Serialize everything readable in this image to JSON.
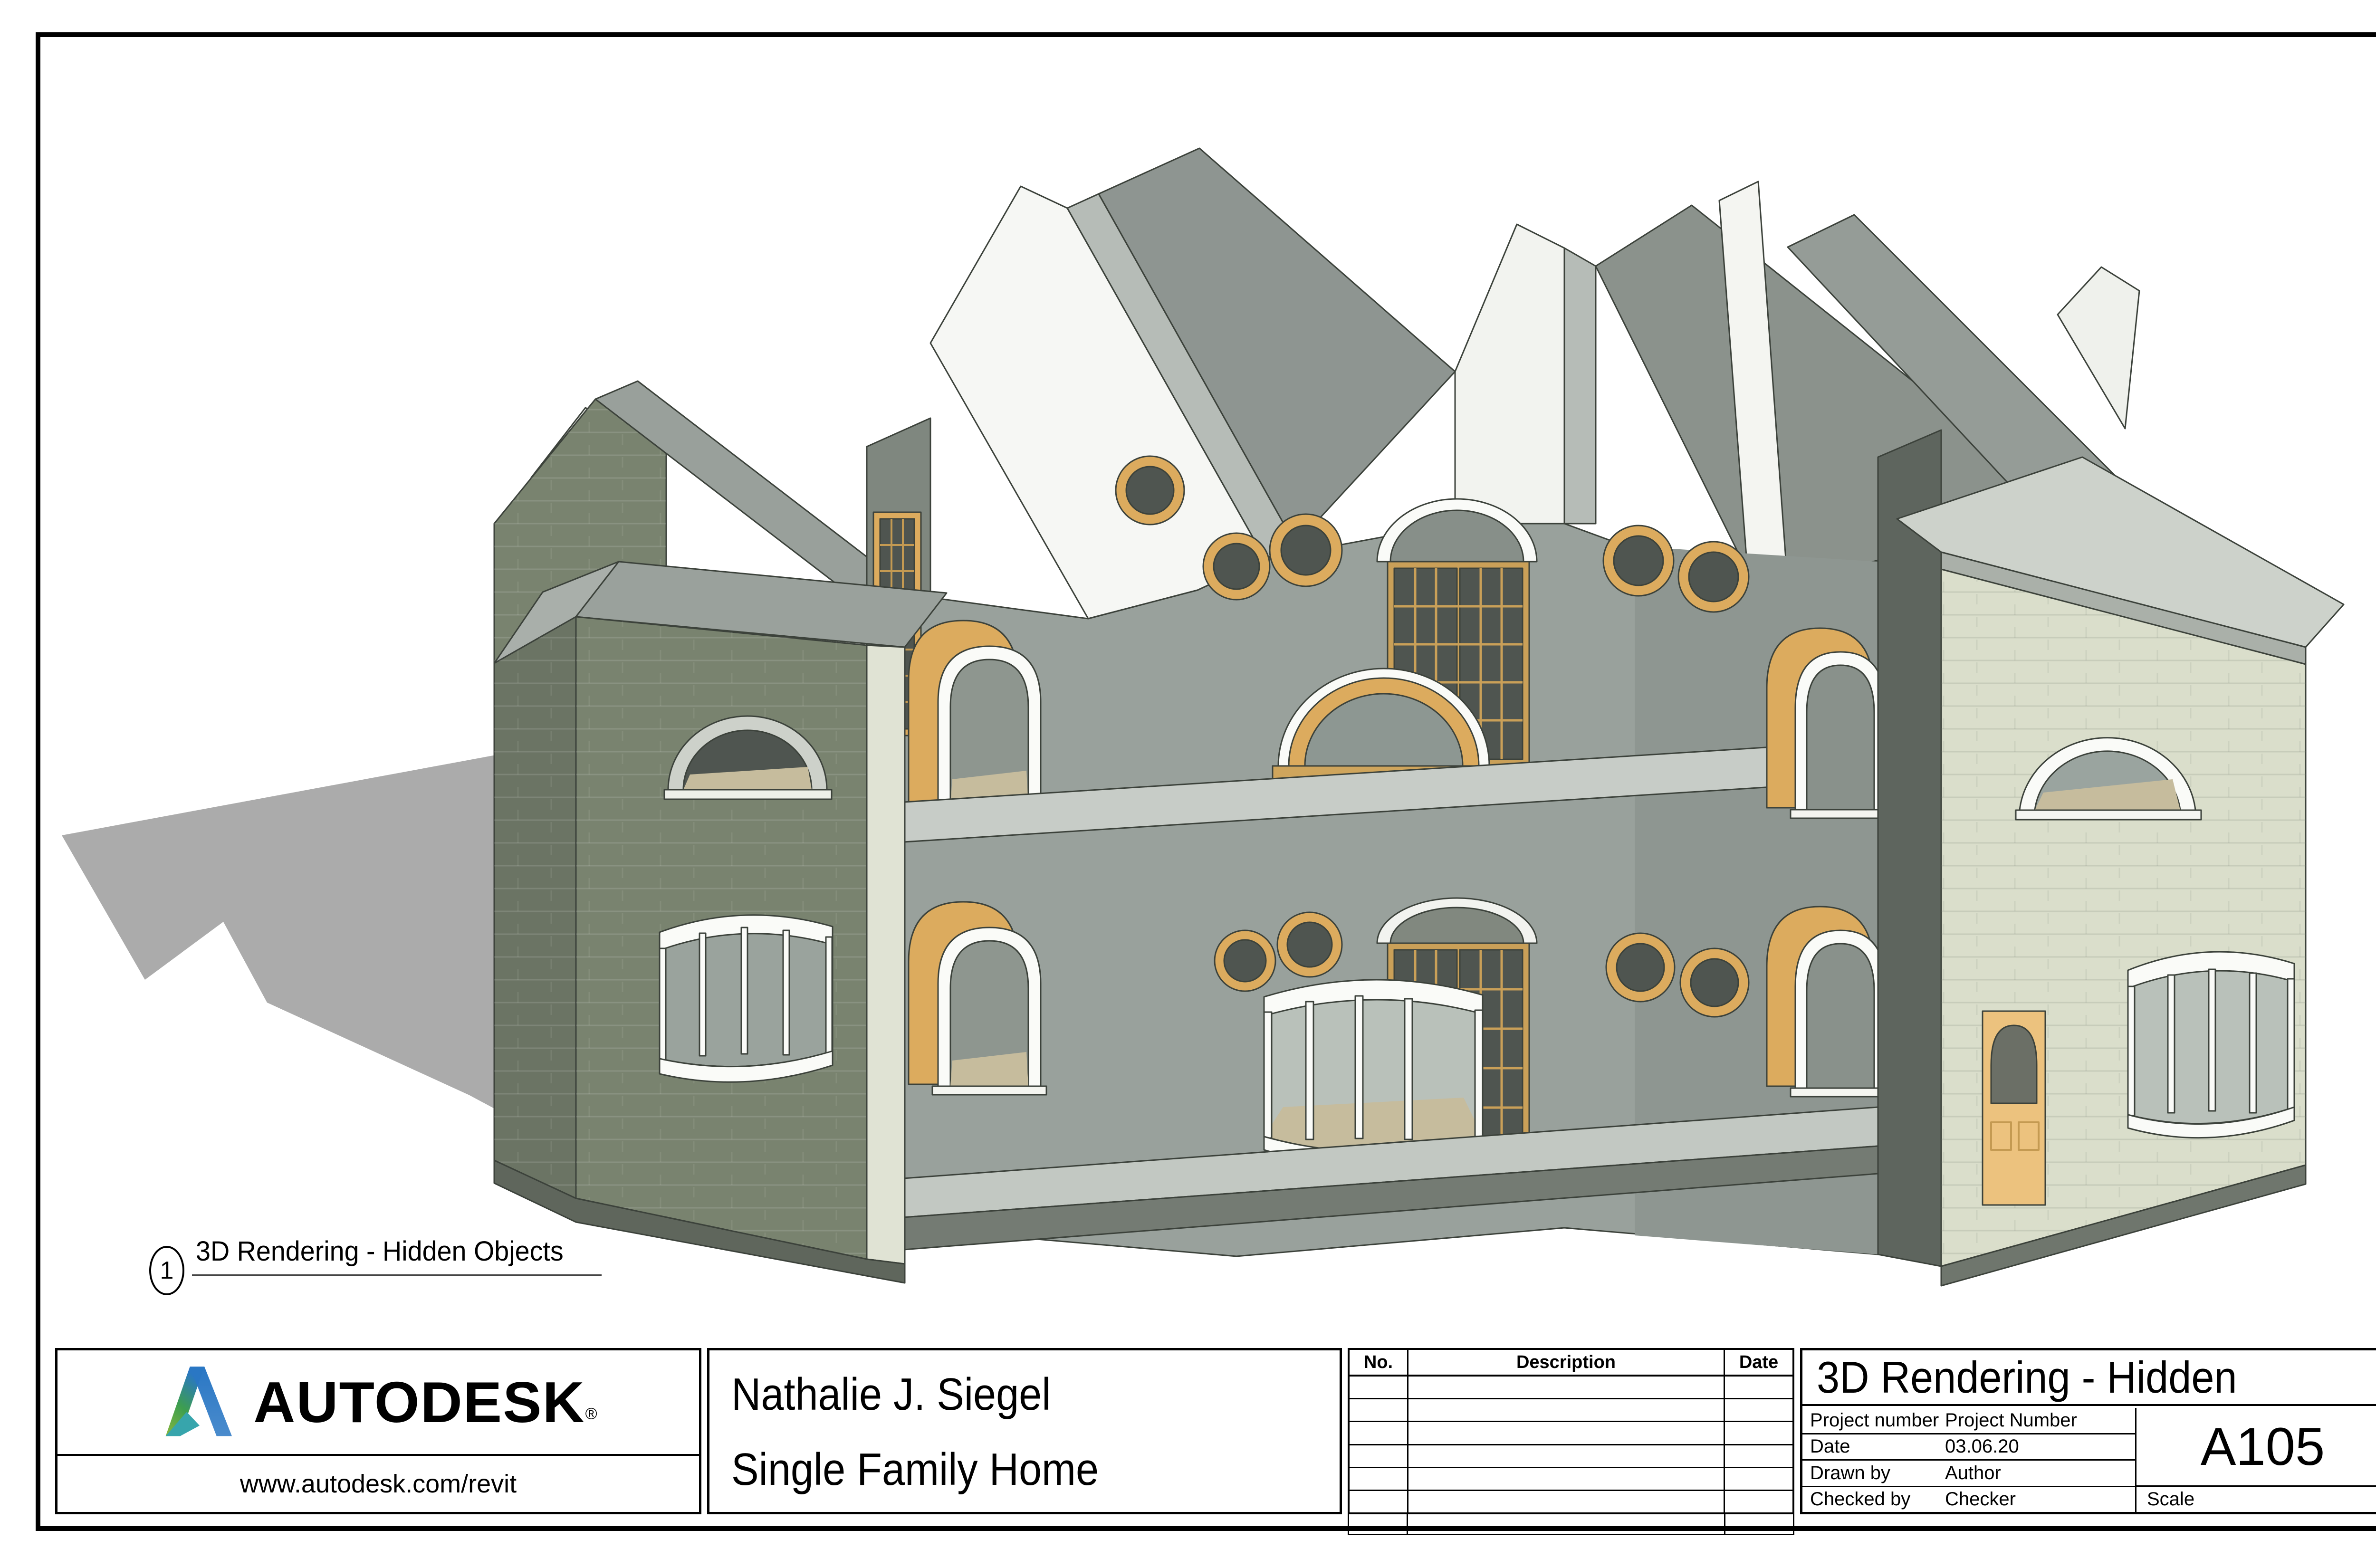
{
  "sheet": {
    "view_label": {
      "number": "1",
      "title": "3D Rendering - Hidden Objects"
    },
    "plot_stamp": "3/8/2020 11:24:47 PM"
  },
  "title_block": {
    "vendor": {
      "brand": "AUTODESK",
      "registered_mark": "®",
      "url": "www.autodesk.com/revit",
      "colors": {
        "green": "#8ab83d",
        "mid": "#3d9e4f",
        "blue": "#2a77c4",
        "teal": "#37a5ac"
      }
    },
    "owner": {
      "name": "Nathalie J. Siegel",
      "project": "Single Family Home"
    },
    "revisions": {
      "headers": {
        "no": "No.",
        "description": "Description",
        "date": "Date"
      },
      "rows": [
        [
          "",
          "",
          ""
        ],
        [
          "",
          "",
          ""
        ],
        [
          "",
          "",
          ""
        ],
        [
          "",
          "",
          ""
        ],
        [
          "",
          "",
          ""
        ],
        [
          "",
          "",
          ""
        ]
      ]
    },
    "sheet_info": {
      "view_title": "3D Rendering - Hidden",
      "fields": [
        {
          "label": "Project number",
          "value": "Project Number"
        },
        {
          "label": "Date",
          "value": "03.06.20"
        },
        {
          "label": "Drawn by",
          "value": "Author"
        },
        {
          "label": "Checked by",
          "value": "Checker"
        }
      ],
      "sheet_number": "A105",
      "scale_label": "Scale",
      "scale_value": ""
    }
  },
  "rendering": {
    "description": "Cutaway axonometric 3D rendering of a two-story single family home with gabled roofs, round porthole windows, arched amber wood windows and curved bay windows",
    "colors": {
      "wall_dark": "#79836f",
      "wall_light": "#dadecb",
      "wall_cut_white": "#f6f7f4",
      "interior_gray": "#99a19c",
      "interior_dark": "#5e655e",
      "roof_gray": "#8e9591",
      "roof_light": "#c7ccc7",
      "wood_amber": "#dcab5e",
      "wood_amber_light": "#ecc27e",
      "glass_dark": "#4f5550",
      "glass_light": "#b9c1ba",
      "trim_white": "#fafbf8",
      "sill_tan": "#c6bc9d",
      "shadow": "#ababab",
      "line": "#333832"
    }
  }
}
